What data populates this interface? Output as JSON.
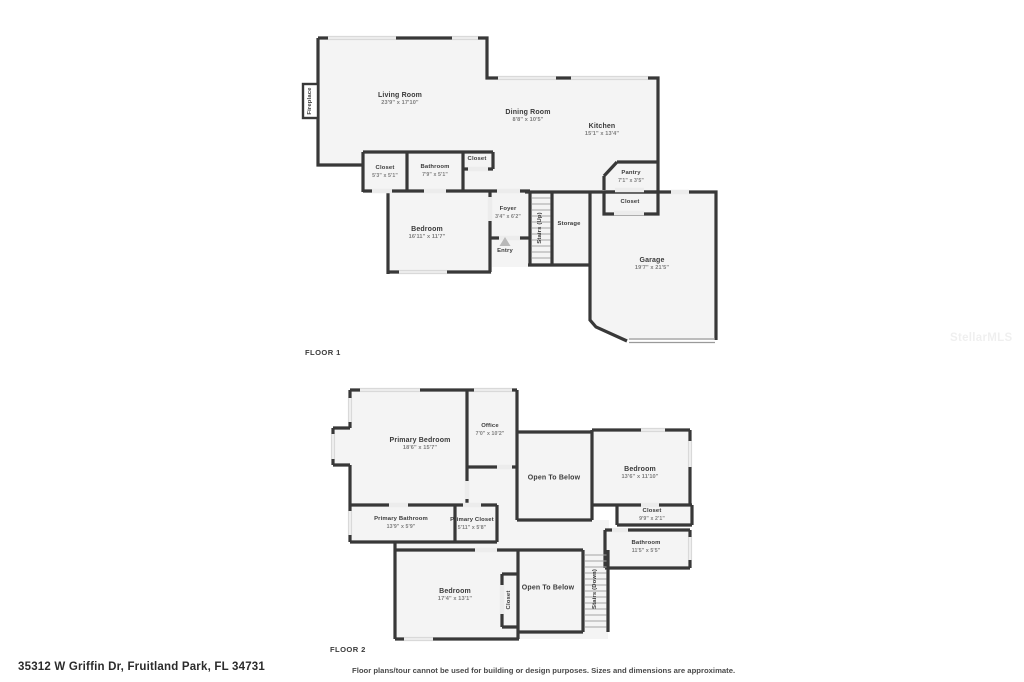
{
  "meta": {
    "address": "35312 W Griffin Dr, Fruitland Park, FL 34731",
    "disclaimer": "Floor plans/tour cannot be used for building or design purposes. Sizes and dimensions are approximate.",
    "watermark": "StellarMLS",
    "colors": {
      "wall": "#383838",
      "room_fill": "#f4f4f4",
      "window": "#d9d9d9",
      "door_gap": "#ececec"
    }
  },
  "floor1": {
    "label": "FLOOR 1",
    "rooms": {
      "fireplace": {
        "name": "Fireplace"
      },
      "living_room": {
        "name": "Living Room",
        "dims": "23'9\" x 17'10\""
      },
      "dining_room": {
        "name": "Dining Room",
        "dims": "8'8\" x 10'5\""
      },
      "kitchen": {
        "name": "Kitchen",
        "dims": "15'1\" x 13'4\""
      },
      "closet1": {
        "name": "Closet",
        "dims": "5'3\" x 5'1\""
      },
      "bathroom": {
        "name": "Bathroom",
        "dims": "7'9\" x 5'1\""
      },
      "closet2": {
        "name": "Closet"
      },
      "bedroom": {
        "name": "Bedroom",
        "dims": "16'11\" x 11'7\""
      },
      "foyer": {
        "name": "Foyer",
        "dims": "3'4\" x 6'2\""
      },
      "stairs_up": {
        "name": "Stairs (Up)"
      },
      "storage": {
        "name": "Storage"
      },
      "entry": {
        "name": "Entry"
      },
      "pantry": {
        "name": "Pantry",
        "dims": "7'1\" x 3'5\""
      },
      "closet3": {
        "name": "Closet"
      },
      "garage": {
        "name": "Garage",
        "dims": "19'7\" x 21'5\""
      }
    }
  },
  "floor2": {
    "label": "FLOOR 2",
    "rooms": {
      "primary_bedroom": {
        "name": "Primary Bedroom",
        "dims": "18'6\" x 15'7\""
      },
      "office": {
        "name": "Office",
        "dims": "7'0\" x 10'2\""
      },
      "open_below_1": {
        "name": "Open To Below"
      },
      "bedroom_right": {
        "name": "Bedroom",
        "dims": "13'6\" x 11'10\""
      },
      "closet_right": {
        "name": "Closet",
        "dims": "9'9\" x 2'1\""
      },
      "primary_bathroom": {
        "name": "Primary Bathroom",
        "dims": "13'9\" x 5'9\""
      },
      "primary_closet": {
        "name": "Primary Closet",
        "dims": "5'11\" x 5'8\""
      },
      "bathroom2": {
        "name": "Bathroom",
        "dims": "11'5\" x 5'5\""
      },
      "bedroom_bottom": {
        "name": "Bedroom",
        "dims": "17'4\" x 13'1\""
      },
      "closet_strip": {
        "name": "Closet"
      },
      "open_below_2": {
        "name": "Open To Below"
      },
      "stairs_down": {
        "name": "Stairs (Down)"
      }
    }
  }
}
